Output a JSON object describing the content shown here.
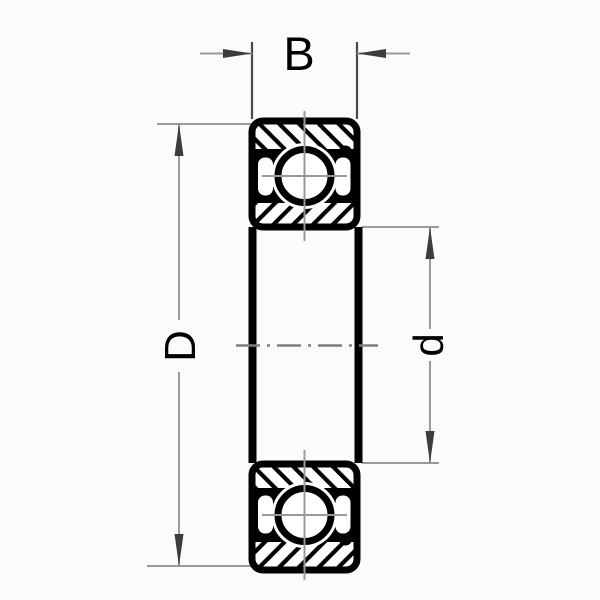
{
  "diagram": {
    "labels": {
      "width": "B",
      "outer_diameter": "D",
      "bore_diameter": "d"
    },
    "colors": {
      "ink": "#000000",
      "dimension_line": "#9a9a9a",
      "extension_line": "#4a4a4a",
      "arrow": "#3c3c3c",
      "centerline": "#7f7f7f",
      "crosshair": "#999999",
      "background": "#fbfbfb"
    }
  }
}
